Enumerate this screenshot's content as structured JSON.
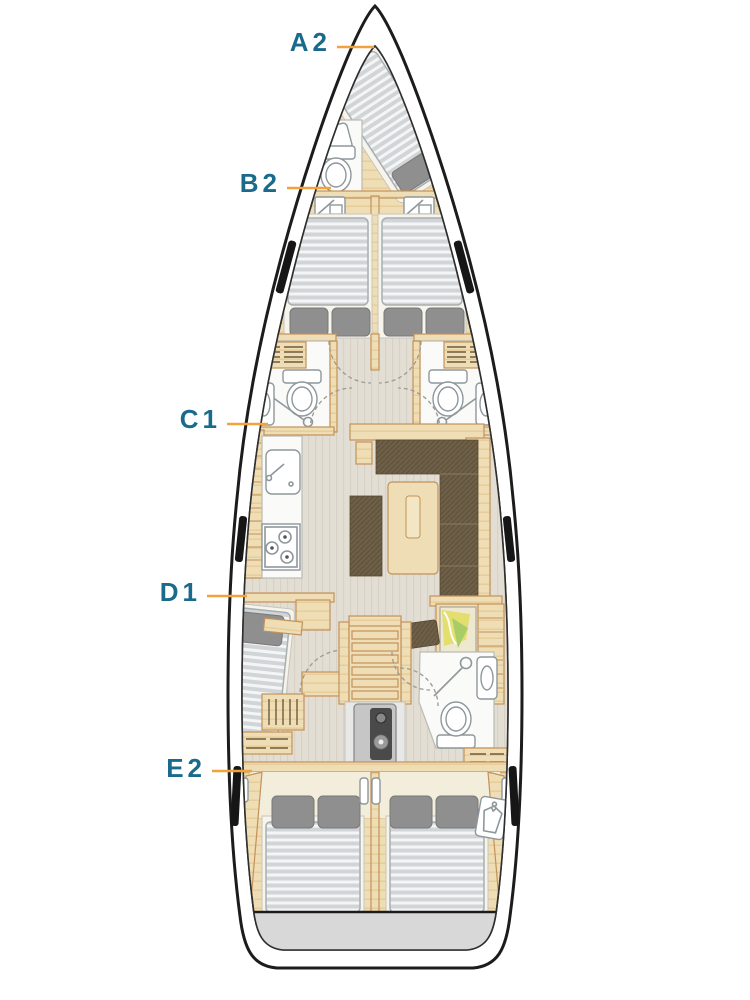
{
  "diagram": {
    "labels": [
      {
        "code": "A2"
      },
      {
        "code": "B2"
      },
      {
        "code": "C1"
      },
      {
        "code": "D1"
      },
      {
        "code": "E2"
      }
    ],
    "colors": {
      "label_text": "#1A6A8C",
      "leader_line": "#F0A23C",
      "hull_outline": "#1C1C1C",
      "wood_fill": "#EFDDB5",
      "wood_edge": "#C2925A",
      "floor_fill": "#E3DED4",
      "upholstery": "#6E5F48",
      "mattress": "#D2D5D7",
      "pillow": "#8F8F8F",
      "fixture": "#FAFAF8",
      "transom": "#D8D8D8"
    },
    "icons": [
      "berth-mattress-icon",
      "pillow-icon",
      "toilet-icon",
      "shower-icon",
      "sink-icon",
      "stove-icon",
      "chart-table-map-icon",
      "companionway-stairs-icon",
      "engine-icon",
      "wardrobe-shirt-icon",
      "door-swing-arc-icon",
      "hull-window-icon",
      "locker-louver-icon"
    ]
  }
}
